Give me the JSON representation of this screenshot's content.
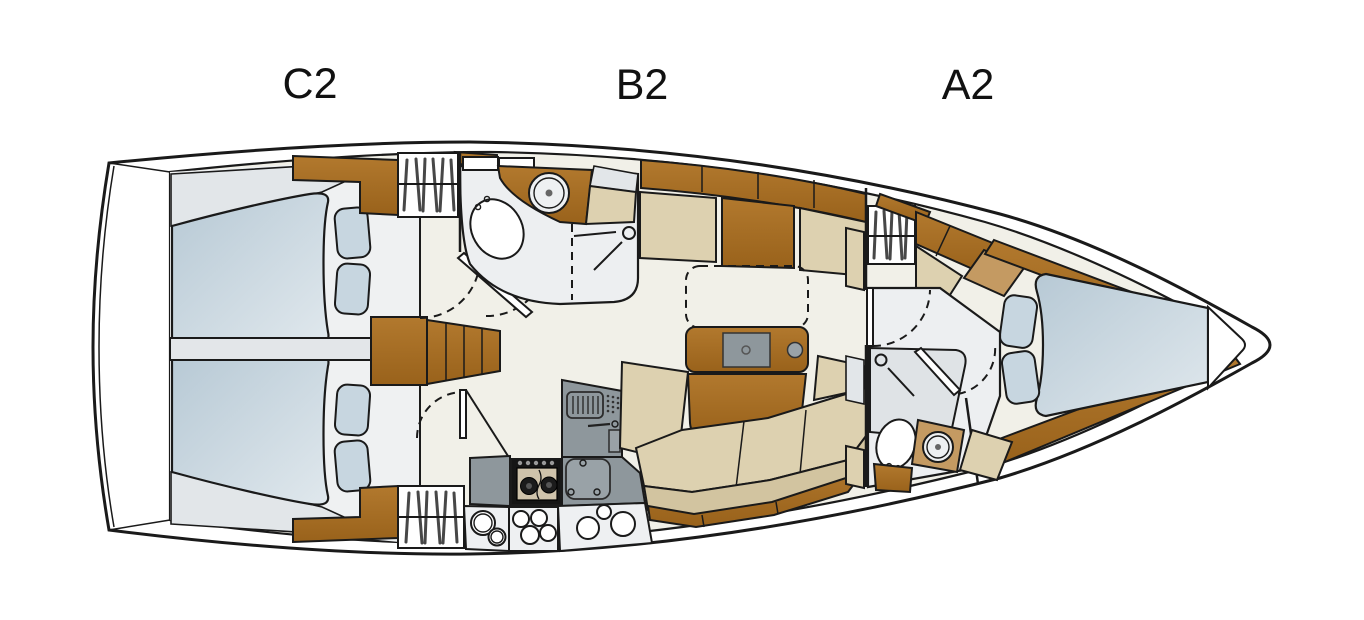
{
  "plan": {
    "type": "sailing-yacht-interior-deck-plan",
    "orientation": "bow-right-stern-left"
  },
  "zones": {
    "c2": {
      "label": "C2",
      "name": "aft-cabins-area"
    },
    "b2": {
      "label": "B2",
      "name": "salon-galley-area"
    },
    "a2": {
      "label": "A2",
      "name": "forward-cabin-area"
    }
  },
  "fixtures": {
    "aft_cabins": [
      "double-berth-port",
      "double-berth-starboard",
      "pillows",
      "hanging-locker",
      "wood-lockers"
    ],
    "companionway": [
      "steps",
      "cabinet"
    ],
    "aft_head": [
      "toilet",
      "round-washbasin",
      "shower",
      "towel-bar",
      "door"
    ],
    "galley": [
      "two-burner-stove",
      "sinks",
      "refrigerator",
      "vented-locker",
      "counters",
      "slatted-locker"
    ],
    "salon": [
      "port-settee",
      "folding-table",
      "table-extension-dashed",
      "u-shaped-settee",
      "wood-lockers"
    ],
    "forward_head": [
      "shower",
      "toilet",
      "round-washbasin",
      "door"
    ],
    "forward_cabin": [
      "v-berth",
      "pillows",
      "hanging-locker",
      "wood-trim"
    ]
  },
  "colors": {
    "outline": "#1a1a1a",
    "wood1": "#b2792e",
    "wood2": "#99621b",
    "woodlight": "#c49a62",
    "beige": "#ddd1b0",
    "beigedark": "#d2c4a0",
    "bed1": "#b7c9d5",
    "bed2": "#e0e8ed",
    "pillow": "#c7d6e0",
    "cream": "#f1f0e8",
    "roomgray": "#edeff1",
    "roomlight": "#eff1f2",
    "wedge": "#e2e6e9",
    "band": "#e3e6e9",
    "counter": "#8e979c",
    "lightcounter": "#eef0f2",
    "showergray": "#dfe3e6",
    "stove": "#151515"
  }
}
